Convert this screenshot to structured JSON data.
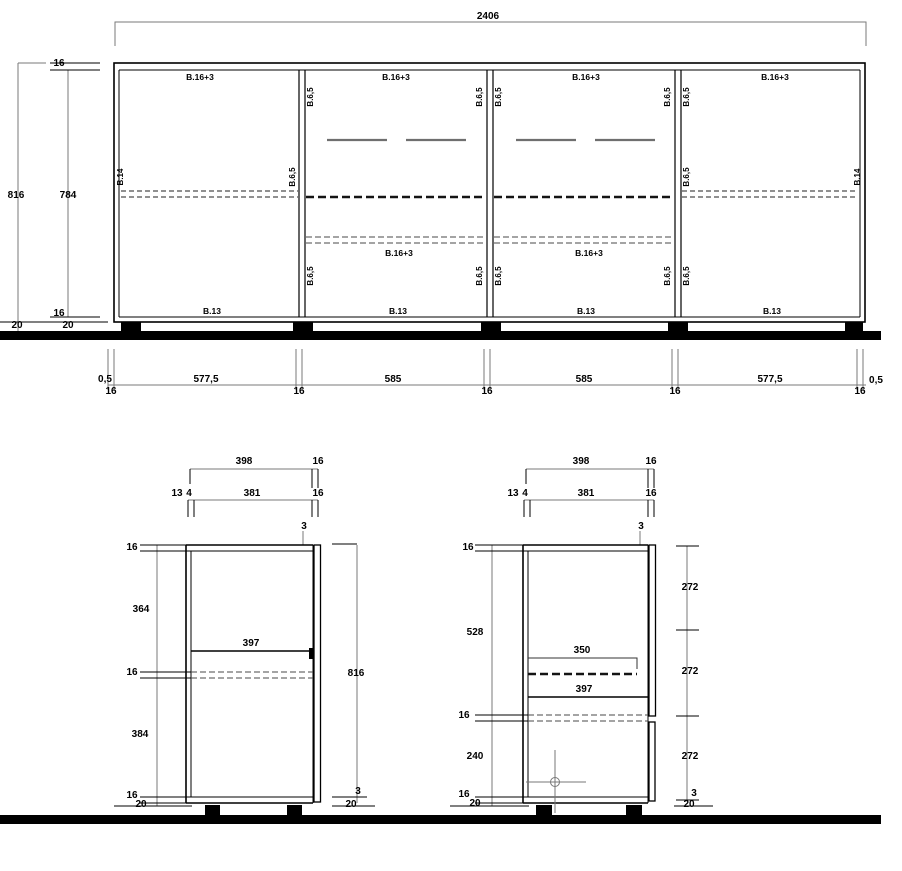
{
  "front_elevation": {
    "overall_width": "2406",
    "height_total": "816",
    "height_internal": "784",
    "top_thickness": "16",
    "bottom_thickness": "16",
    "plinth_dims": [
      "20",
      "20"
    ],
    "panel_top_labels": [
      "B.16+3",
      "B.16+3",
      "B.16+3",
      "B.16+3"
    ],
    "mid_panel_labels": [
      "B.16+3",
      "B.16+3"
    ],
    "panel_bottom_labels": [
      "B.13",
      "B.13",
      "B.13",
      "B.13"
    ],
    "vertical_labels": [
      "B.14",
      "B.6,5",
      "B.6,5",
      "B.6,5",
      "B.6,5",
      "B.6,5",
      "B.6,5",
      "B.6,5",
      "B.6,5",
      "B.6,5",
      "B.6,5",
      "B.6,5",
      "B.6,5",
      "B.14"
    ],
    "bottom_dims": [
      "0,5",
      "577,5",
      "585",
      "585",
      "577,5",
      "0,5"
    ],
    "divider_dims": [
      "16",
      "16",
      "16",
      "16",
      "16"
    ]
  },
  "section_a": {
    "top_dims": [
      "398",
      "16",
      "13",
      "4",
      "381",
      "16"
    ],
    "door_gap_top": "3",
    "height": "816",
    "shelf_dim": "397",
    "left_dims": [
      "16",
      "364",
      "16",
      "384",
      "16",
      "20"
    ],
    "door_gap_bottom": "3",
    "plinth_right": "20"
  },
  "section_b": {
    "top_dims": [
      "398",
      "16",
      "13",
      "4",
      "381",
      "16"
    ],
    "door_gap_top": "3",
    "flap_dim": "350",
    "shelf_dim": "397",
    "left_dims": [
      "16",
      "528",
      "16",
      "240",
      "16",
      "20"
    ],
    "right_dims": [
      "272",
      "272",
      "272"
    ],
    "door_gap_bottom": "3",
    "plinth_right": "20"
  }
}
